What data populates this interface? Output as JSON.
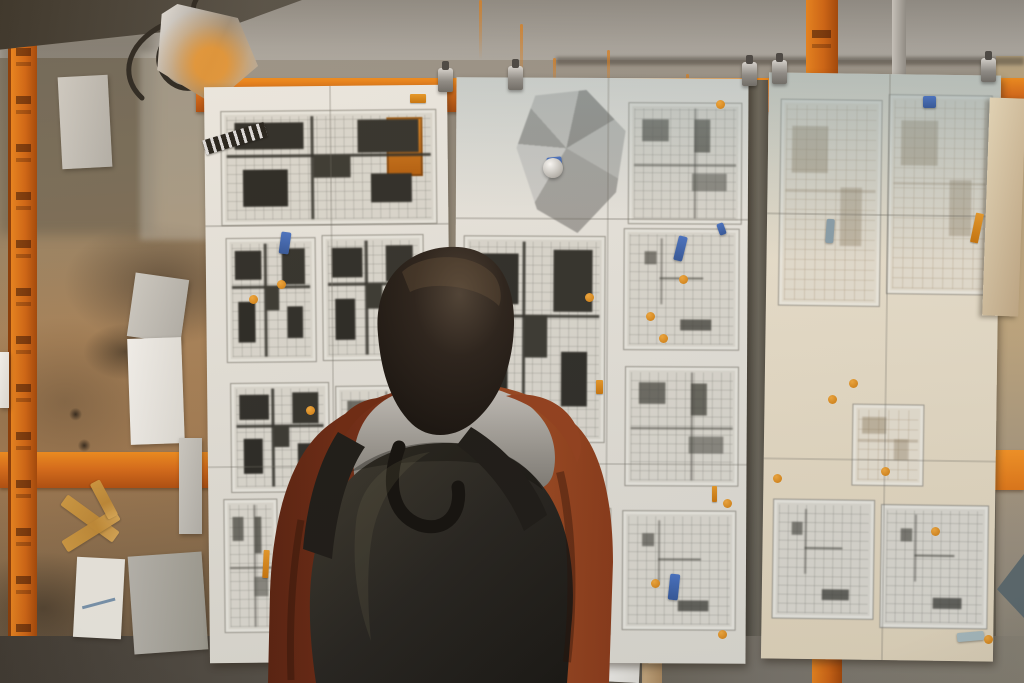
{
  "scene": {
    "alt": "Person with a dark backpack and rust-colored jacket viewing architectural floor-plan sheets clipped to an orange site rack on a concrete wall"
  },
  "palette": {
    "orange_rail": "#d96d1a",
    "orange_bright": "#ef8c1e",
    "wall_gray": "#a3a099",
    "wall_tan": "#a8835a",
    "sheet_white": "#e8e6df",
    "sheet_cream": "#efe7d6",
    "plan_ink": "#30302c",
    "jacket_rust": "#8a3a1a",
    "hoodie_gray": "#9b9892",
    "hair_dark": "#1a1512",
    "backpack_charcoal": "#26231e",
    "tab_blue": "#4a74c4",
    "dot_orange": "#cf7d12",
    "tape_tan": "#cf9a42"
  },
  "sheets": [
    {
      "id": "left",
      "x": 207,
      "y": 86,
      "w": 243,
      "h": 576,
      "rot": -0.6,
      "tone": "white",
      "tint": 0,
      "plans": [
        {
          "x": 16,
          "y": 24,
          "w": 214,
          "h": 113,
          "style": "dense",
          "accent": true
        },
        {
          "x": 20,
          "y": 151,
          "w": 88,
          "h": 123,
          "style": "dense"
        },
        {
          "x": 116,
          "y": 149,
          "w": 100,
          "h": 124,
          "style": "dense"
        },
        {
          "x": 23,
          "y": 296,
          "w": 97,
          "h": 108,
          "style": "dense"
        },
        {
          "x": 128,
          "y": 300,
          "w": 86,
          "h": 100,
          "style": "medium"
        },
        {
          "x": 15,
          "y": 412,
          "w": 52,
          "h": 132,
          "style": "medium"
        },
        {
          "x": 74,
          "y": 416,
          "w": 74,
          "h": 120,
          "style": "grid"
        }
      ]
    },
    {
      "id": "middle",
      "x": 455,
      "y": 78,
      "w": 292,
      "h": 585,
      "rot": 0.3,
      "tone": "white",
      "tint": 1,
      "crumple": {
        "x": 58,
        "y": 12,
        "w": 116,
        "h": 146
      },
      "plans": [
        {
          "x": 172,
          "y": 24,
          "w": 112,
          "h": 120,
          "style": "medium"
        },
        {
          "x": 8,
          "y": 158,
          "w": 140,
          "h": 205,
          "style": "dense"
        },
        {
          "x": 168,
          "y": 150,
          "w": 114,
          "h": 120,
          "style": "grid"
        },
        {
          "x": 170,
          "y": 288,
          "w": 112,
          "h": 118,
          "style": "medium"
        },
        {
          "x": 168,
          "y": 432,
          "w": 112,
          "h": 118,
          "style": "grid"
        },
        {
          "x": 10,
          "y": 430,
          "w": 145,
          "h": 125,
          "style": "faint"
        }
      ]
    },
    {
      "id": "right",
      "x": 765,
      "y": 74,
      "w": 232,
      "h": 586,
      "rot": 0.8,
      "tone": "cream",
      "tint": 2,
      "plans": [
        {
          "x": 12,
          "y": 26,
          "w": 100,
          "h": 205,
          "style": "faint"
        },
        {
          "x": 120,
          "y": 20,
          "w": 102,
          "h": 198,
          "style": "faint"
        },
        {
          "x": 88,
          "y": 330,
          "w": 70,
          "h": 80,
          "style": "faint"
        },
        {
          "x": 10,
          "y": 426,
          "w": 100,
          "h": 118,
          "style": "grid"
        },
        {
          "x": 118,
          "y": 430,
          "w": 106,
          "h": 122,
          "style": "grid"
        }
      ]
    }
  ],
  "clips": [
    {
      "x": 438,
      "y": 68
    },
    {
      "x": 508,
      "y": 66
    },
    {
      "x": 742,
      "y": 62
    },
    {
      "x": 772,
      "y": 60
    },
    {
      "x": 981,
      "y": 58
    }
  ],
  "annotations": {
    "tabs": [
      {
        "x": 280,
        "y": 232,
        "w": 10,
        "h": 22,
        "rot": 8
      },
      {
        "x": 547,
        "y": 157,
        "w": 15,
        "h": 13,
        "rot": -6
      },
      {
        "x": 676,
        "y": 236,
        "w": 9,
        "h": 25,
        "rot": 14
      },
      {
        "x": 718,
        "y": 223,
        "w": 7,
        "h": 12,
        "rot": -20
      },
      {
        "x": 923,
        "y": 96,
        "w": 13,
        "h": 12,
        "rot": 0
      },
      {
        "x": 669,
        "y": 574,
        "w": 10,
        "h": 26,
        "rot": 6
      },
      {
        "x": 826,
        "y": 219,
        "w": 8,
        "h": 24,
        "rot": 4,
        "color": "#8aa0ac"
      },
      {
        "x": 957,
        "y": 632,
        "w": 27,
        "h": 9,
        "rot": -5,
        "color": "#a9bcc0"
      }
    ],
    "dots": [
      [
        720,
        104
      ],
      [
        683,
        279
      ],
      [
        663,
        338
      ],
      [
        650,
        316
      ],
      [
        589,
        297
      ],
      [
        253,
        299
      ],
      [
        281,
        284
      ],
      [
        310,
        410
      ],
      [
        853,
        383
      ],
      [
        832,
        399
      ],
      [
        727,
        503
      ],
      [
        777,
        478
      ],
      [
        885,
        471
      ],
      [
        935,
        531
      ],
      [
        655,
        583
      ],
      [
        722,
        634
      ],
      [
        988,
        639
      ]
    ],
    "dashes": [
      {
        "x": 410,
        "y": 94,
        "w": 16,
        "h": 9,
        "rot": 0
      },
      {
        "x": 263,
        "y": 550,
        "w": 6,
        "h": 28,
        "rot": 3
      },
      {
        "x": 973,
        "y": 213,
        "w": 8,
        "h": 30,
        "rot": 12
      },
      {
        "x": 712,
        "y": 486,
        "w": 5,
        "h": 16,
        "rot": 0
      },
      {
        "x": 596,
        "y": 380,
        "w": 7,
        "h": 14,
        "rot": 0
      }
    ],
    "pin": {
      "x": 543,
      "y": 158
    }
  },
  "scraps": [
    {
      "x": 60,
      "y": 76,
      "w": 50,
      "h": 92,
      "rot": -3,
      "tone": "gray"
    },
    {
      "x": 131,
      "y": 276,
      "w": 54,
      "h": 64,
      "rot": 8,
      "tone": "gray"
    },
    {
      "x": 129,
      "y": 338,
      "w": 54,
      "h": 106,
      "rot": -2,
      "tone": "bright"
    },
    {
      "x": 179,
      "y": 438,
      "w": 23,
      "h": 96,
      "rot": 0,
      "tone": "gray"
    },
    {
      "x": 75,
      "y": 558,
      "w": 48,
      "h": 80,
      "rot": 3,
      "tone": "note"
    },
    {
      "x": 131,
      "y": 554,
      "w": 74,
      "h": 98,
      "rot": -4,
      "tone": "dim"
    },
    {
      "x": 598,
      "y": 640,
      "w": 42,
      "h": 42,
      "rot": 3,
      "tone": "bright"
    },
    {
      "x": 0,
      "y": 352,
      "w": 9,
      "h": 56,
      "rot": 0,
      "tone": "bright"
    },
    {
      "x": 930,
      "y": 222,
      "w": 66,
      "h": 14,
      "rot": -18,
      "tone": "dim"
    }
  ],
  "tapes": [
    {
      "x": 58,
      "y": 512,
      "w": 64,
      "h": 13,
      "rot": 36
    },
    {
      "x": 60,
      "y": 524,
      "w": 62,
      "h": 13,
      "rot": -32
    },
    {
      "x": 84,
      "y": 494,
      "w": 40,
      "h": 11,
      "rot": 62
    }
  ],
  "drips": [
    {
      "x": 479,
      "y": 0,
      "h": 60
    },
    {
      "x": 520,
      "y": 24,
      "h": 70
    },
    {
      "x": 607,
      "y": 50,
      "h": 45
    },
    {
      "x": 553,
      "y": 58,
      "h": 32
    },
    {
      "x": 686,
      "y": 74,
      "h": 20
    }
  ]
}
